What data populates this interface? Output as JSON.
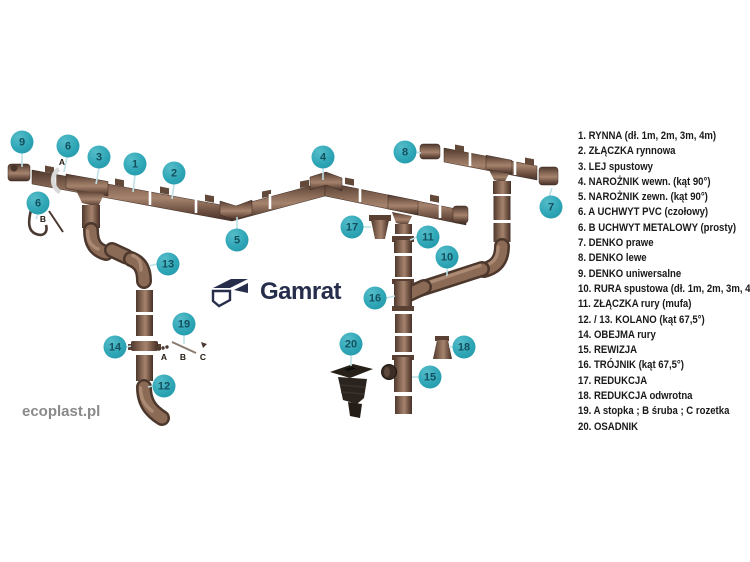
{
  "brand": {
    "logo_text": "Gamrat",
    "logo_color": "#262e4c",
    "website": "ecoplast.pl"
  },
  "colors": {
    "accent_teal": "#2ea6b6",
    "callout_number": "#14505e",
    "leader_line": "#bfe2e6",
    "pipe_brown_mid": "#8b6a56",
    "pipe_brown_dark": "#4c372c",
    "pipe_brown_light": "#b5947c",
    "osadnik_black": "#2b241e",
    "legend_text": "#191919",
    "website_gray": "#8a8a8a"
  },
  "legend": {
    "items": [
      "1. RYNNA (dł. 1m, 2m, 3m, 4m)",
      "2. ZŁĄCZKA rynnowa",
      "3. LEJ spustowy",
      "4. NAROŻNIK wewn. (kąt 90°)",
      "5. NAROŻNIK zewn. (kąt 90°)",
      "6. A UCHWYT PVC (czołowy)",
      "6. B UCHWYT METALOWY (prosty)",
      "7. DENKO prawe",
      "8. DENKO lewe",
      "9. DENKO uniwersalne",
      "10. RURA spustowa (dł. 1m, 2m, 3m, 4m)",
      "11. ZŁĄCZKA rury (mufa)",
      "12. / 13. KOLANO (kąt 67,5°)",
      "14. OBEJMA rury",
      "15. REWIZJA",
      "16. TRÓJNIK (kąt 67,5°)",
      "17. REDUKCJA",
      "18. REDUKCJA odwrotna",
      "19. A stopka ; B śruba ; C rozetka",
      "20. OSADNIK"
    ]
  },
  "callouts": [
    {
      "n": "9"
    },
    {
      "n": "6"
    },
    {
      "n": "3"
    },
    {
      "n": "1"
    },
    {
      "n": "2"
    },
    {
      "n": "6"
    },
    {
      "n": "13"
    },
    {
      "n": "5"
    },
    {
      "n": "4"
    },
    {
      "n": "17"
    },
    {
      "n": "8"
    },
    {
      "n": "7"
    },
    {
      "n": "11"
    },
    {
      "n": "10"
    },
    {
      "n": "16"
    },
    {
      "n": "20"
    },
    {
      "n": "18"
    },
    {
      "n": "15"
    },
    {
      "n": "14"
    },
    {
      "n": "19"
    },
    {
      "n": "12"
    }
  ],
  "diagram_labels": {
    "holder_a": "A",
    "holder_b": "B",
    "acc_a": "A",
    "acc_b": "B",
    "acc_c": "C"
  }
}
